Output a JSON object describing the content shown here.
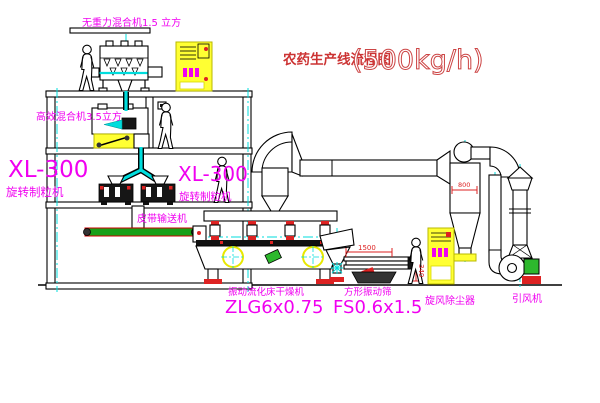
{
  "title": {
    "line_name": "农药生产线流程图",
    "capacity": "(500kg/h)"
  },
  "equipment_labels": {
    "weightless_mixer": "无重力混合机1.5 立方",
    "high_efficiency_mixer": "高效混合机3.5立方",
    "granulator_left_model": "XL-300",
    "granulator_left_name": "旋转制粒机",
    "granulator_mid_model": "XL-300",
    "granulator_mid_name": "旋转制粒机",
    "belt_conveyor": "皮带输送机",
    "fluid_bed_dryer_name": "振动流化床干燥机",
    "fluid_bed_dryer_model": "ZLG6x0.75",
    "square_sieve_name": "方形振动筛",
    "square_sieve_model": "FS0.6x1.5",
    "cyclone": "旋风除尘器",
    "induced_draft_fan": "引风机"
  },
  "dimensions": {
    "sieve_length": "1500",
    "sieve_height": "340",
    "cyclone_width": "800"
  },
  "colors": {
    "background": "#ffffff",
    "line_black": "#000000",
    "label_magenta": "#f000f0",
    "title_red": "#cc3333",
    "title_outline_red": "#cc4444",
    "pipe_cyan": "#00dddd",
    "cabinet_yellow": "#ffff33",
    "belt_green": "#18a018",
    "accent_red": "#dd2222",
    "motor_green": "#2db82d"
  }
}
